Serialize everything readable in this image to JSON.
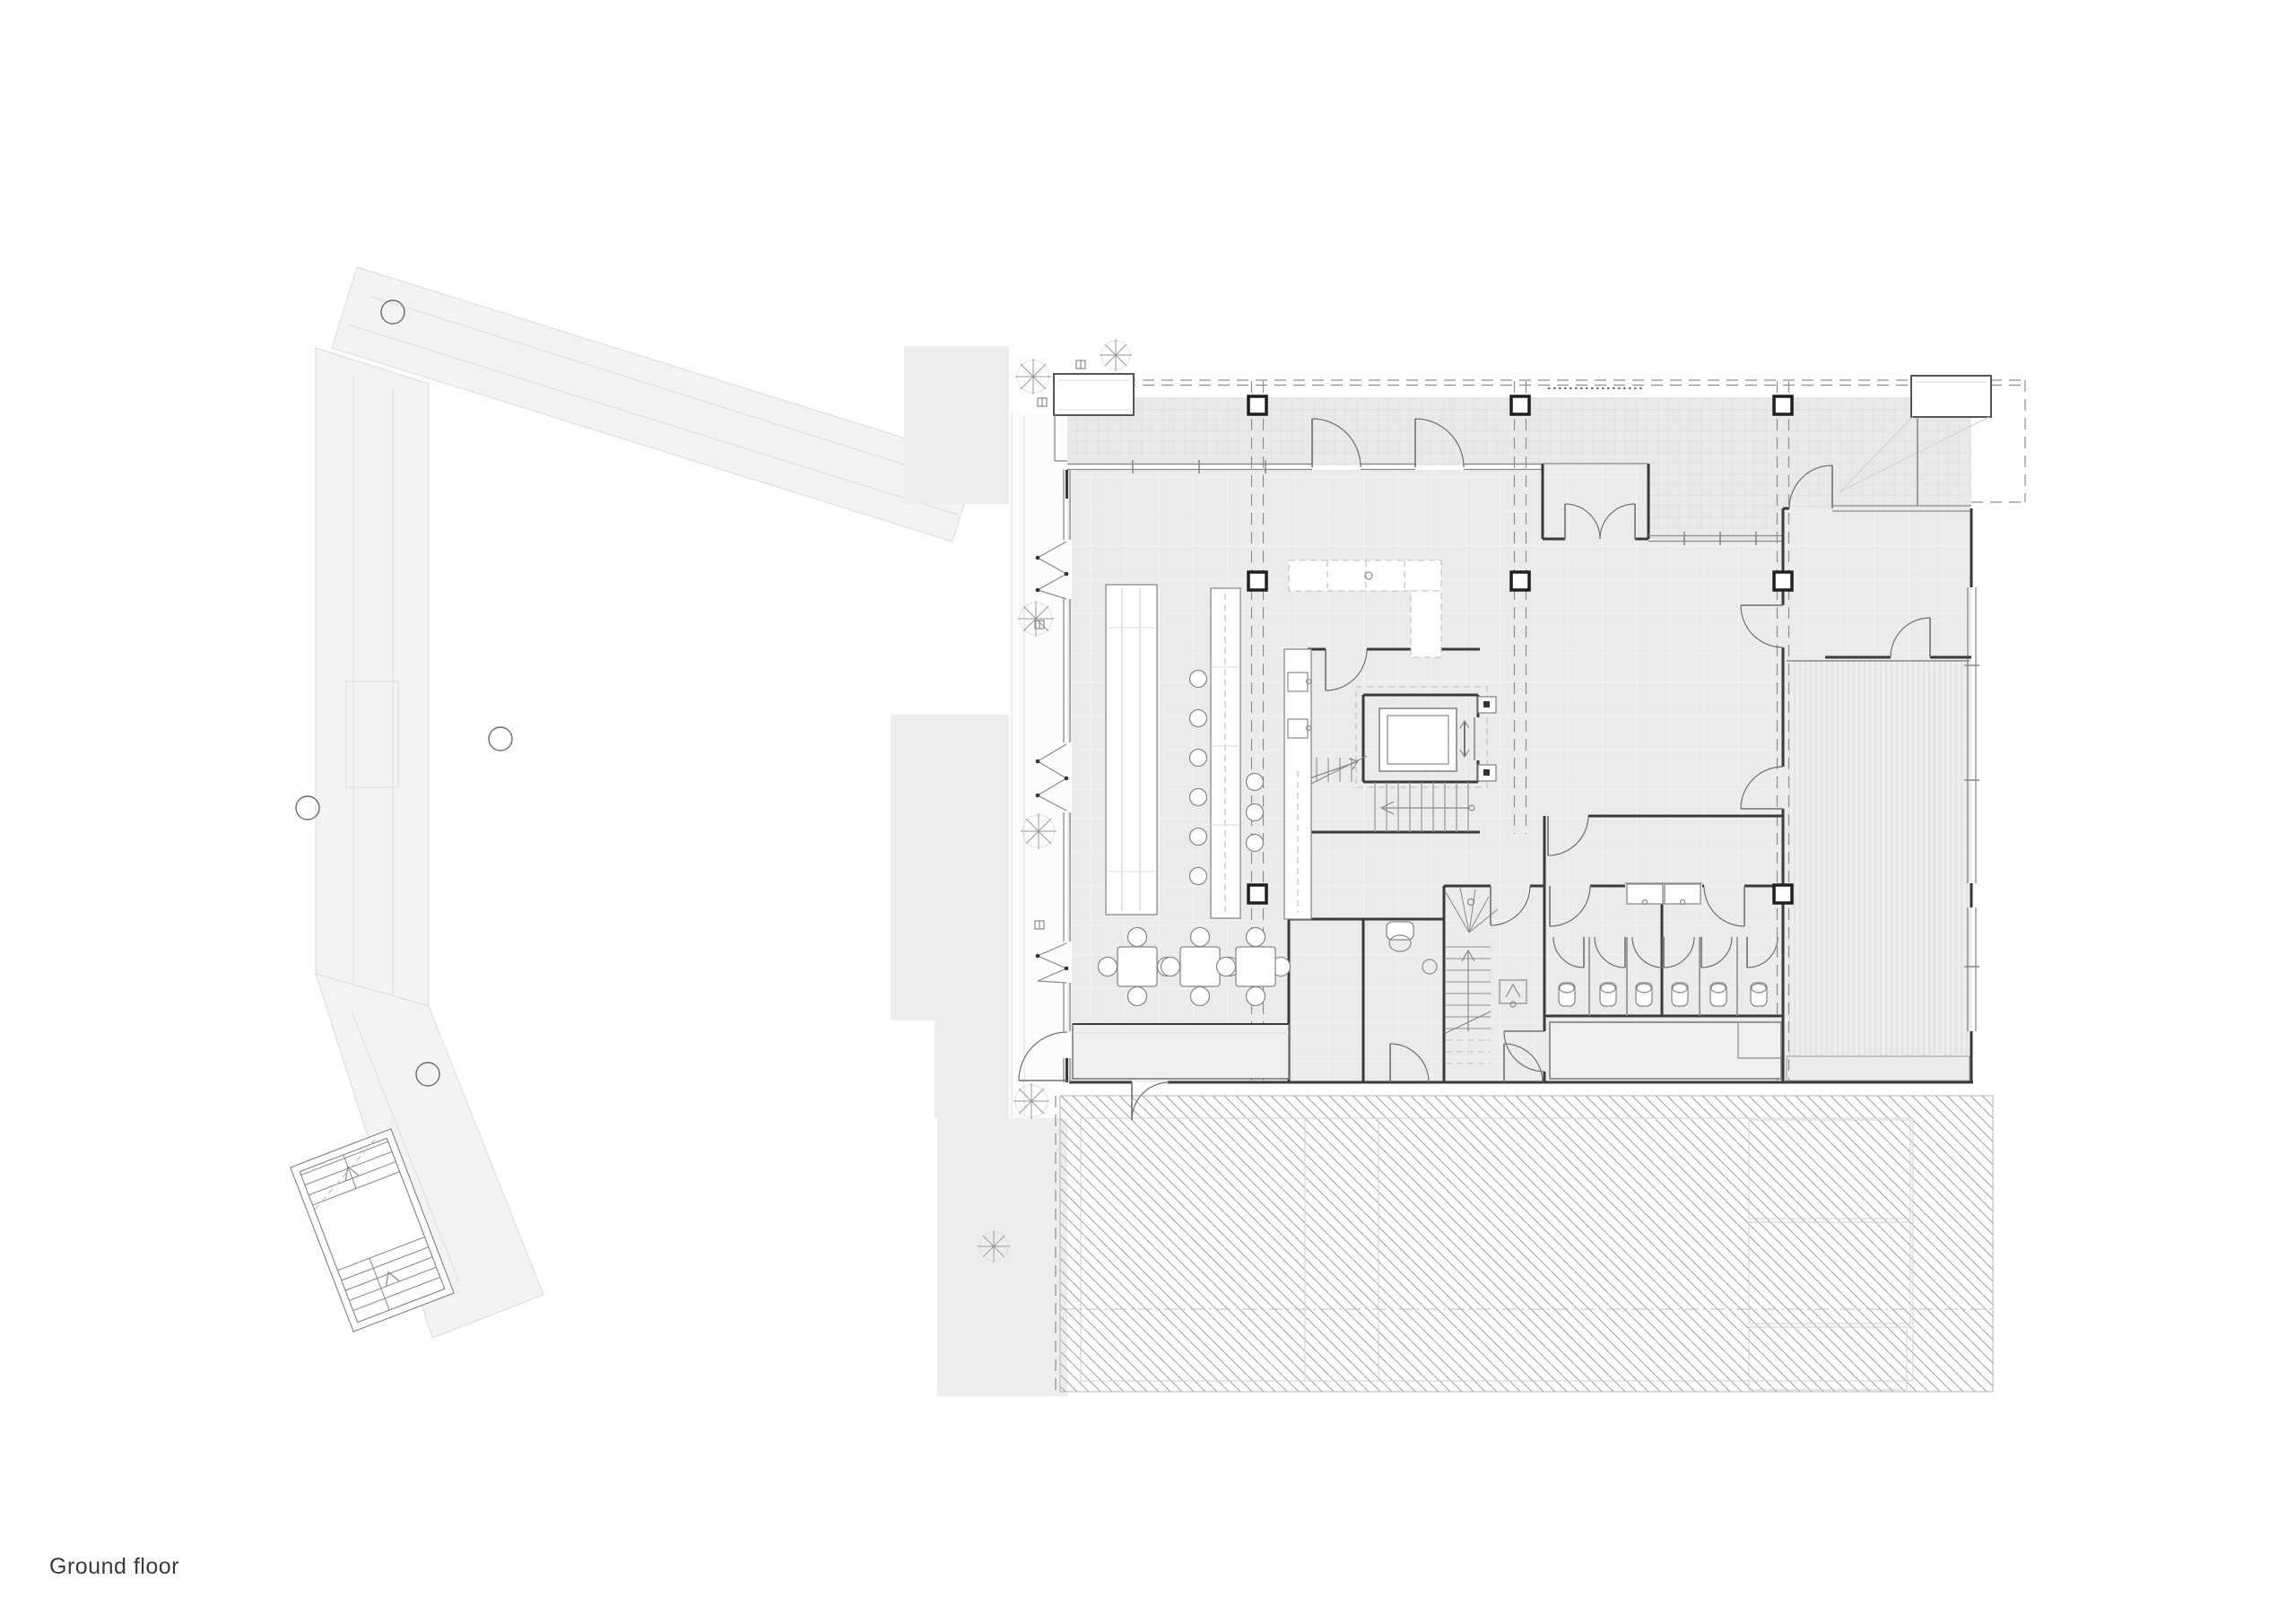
{
  "label": {
    "text": "Ground floor"
  },
  "drawing": {
    "type": "architectural-floor-plan",
    "floor": "Ground floor",
    "features": [
      "context-building-outline",
      "street-terrace-with-canopy",
      "dining-hall",
      "bar-counter-with-stools",
      "shelf-unit",
      "kitchen-counters",
      "elevator",
      "main-staircase",
      "secondary-winder-staircase",
      "wc-cubicles",
      "accessible-wc",
      "right-hall",
      "meeting-room",
      "decking-zone",
      "hatched-basement-zone",
      "structural-grid-columns",
      "folding-facade-doors"
    ]
  },
  "theme": {
    "page_bg": "#ffffff",
    "label_color": "#3a3a3a",
    "wall_color": "#3a3a3a",
    "line_medium": "#8a8a8a",
    "line_light": "#bdbdbd",
    "dash_color": "#8f8f8f",
    "door_color": "#6f6f6f",
    "floor_fill": "#ebebeb",
    "terrace_fill": "#e9e9e9",
    "stripe_fill": "#ededed",
    "bench_fill": "#efefef",
    "hatch_line": "#a3a3a3",
    "context_line": "#e0e0e0",
    "context_fill": "#f3f3f3"
  }
}
